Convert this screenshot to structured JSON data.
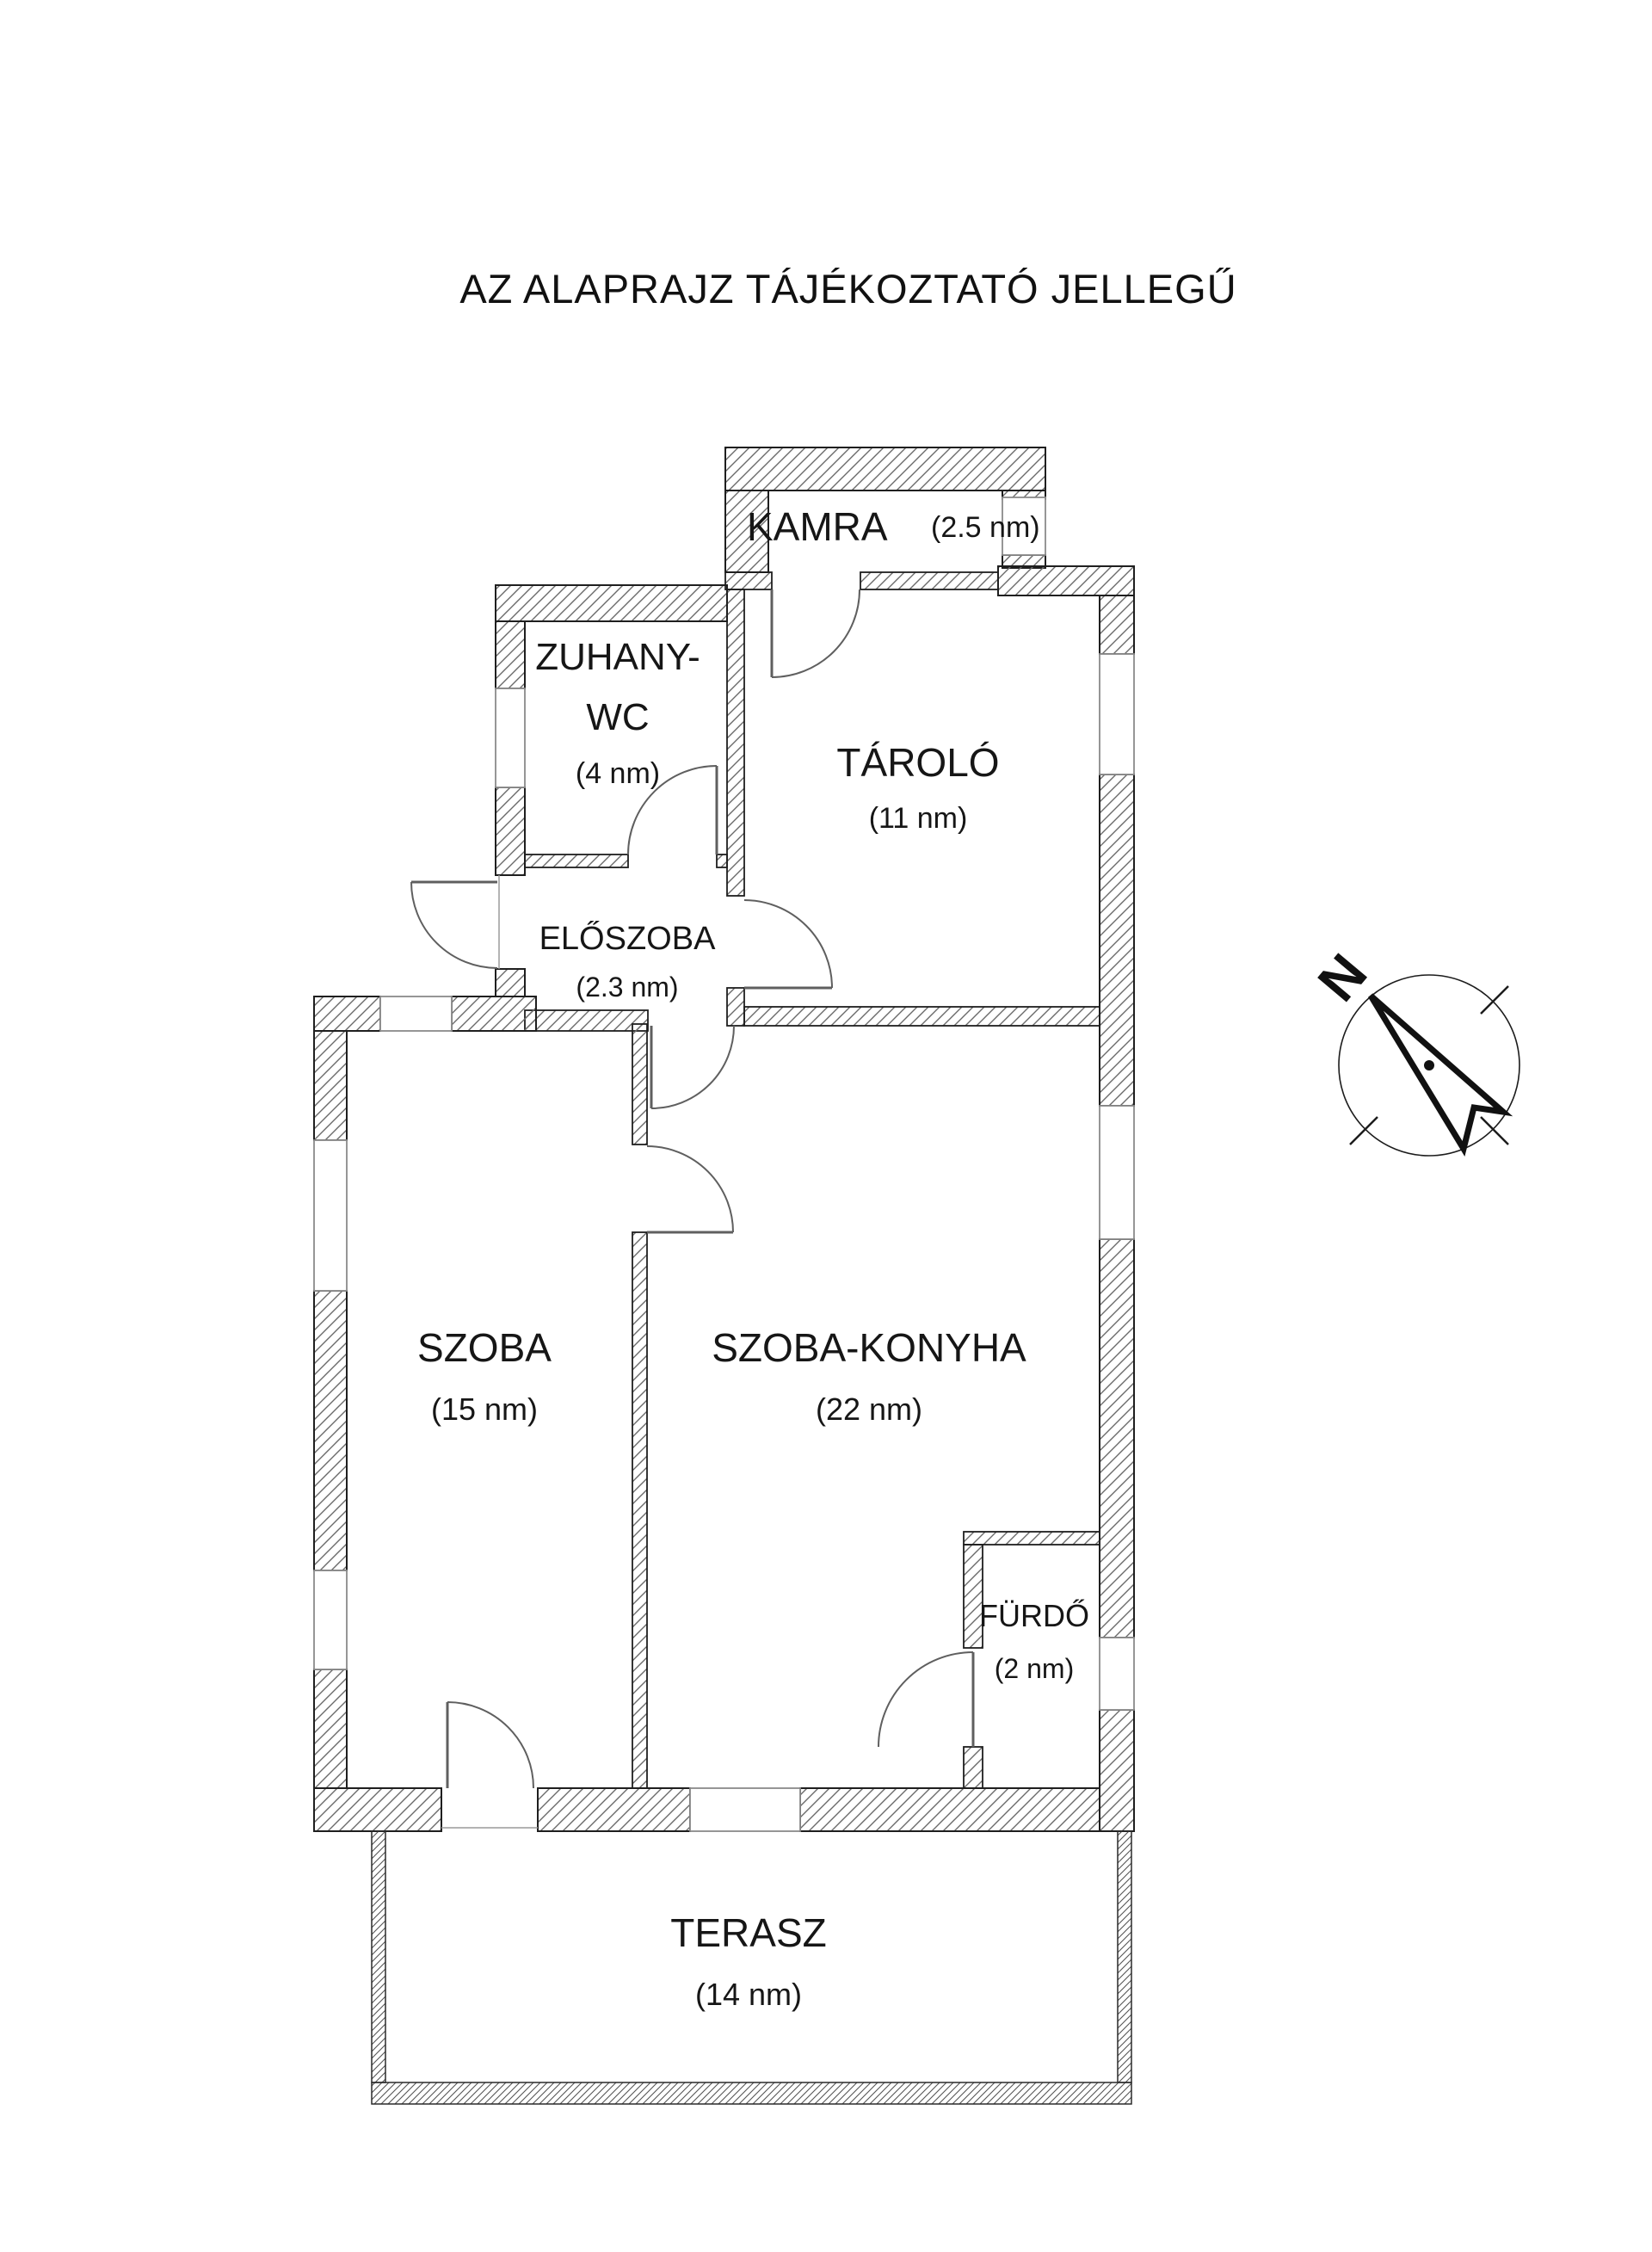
{
  "title": "AZ ALAPRAJZ TÁJÉKOZTATÓ JELLEGŰ",
  "rooms": {
    "kamra": {
      "name": "KAMRA",
      "area": "(2.5 nm)"
    },
    "zuhany_wc": {
      "name_line1": "ZUHANY-",
      "name_line2": "WC",
      "area": "(4 nm)"
    },
    "tarolo": {
      "name": "TÁROLÓ",
      "area": "(11 nm)"
    },
    "eloszoba": {
      "name": "ELŐSZOBA",
      "area": "(2.3 nm)"
    },
    "szoba": {
      "name": "SZOBA",
      "area": "(15 nm)"
    },
    "szoba_konyha": {
      "name": "SZOBA-KONYHA",
      "area": "(22 nm)"
    },
    "furdo": {
      "name": "FÜRDŐ",
      "area": "(2 nm)"
    },
    "terasz": {
      "name": "TERASZ",
      "area": "(14 nm)"
    }
  },
  "compass": {
    "north_label": "N"
  },
  "colors": {
    "background": "#ffffff",
    "wall_outline": "#1f1f1f",
    "hatch_line": "#6a6a6a",
    "door_line": "#5f5f5f",
    "text": "#161616"
  }
}
